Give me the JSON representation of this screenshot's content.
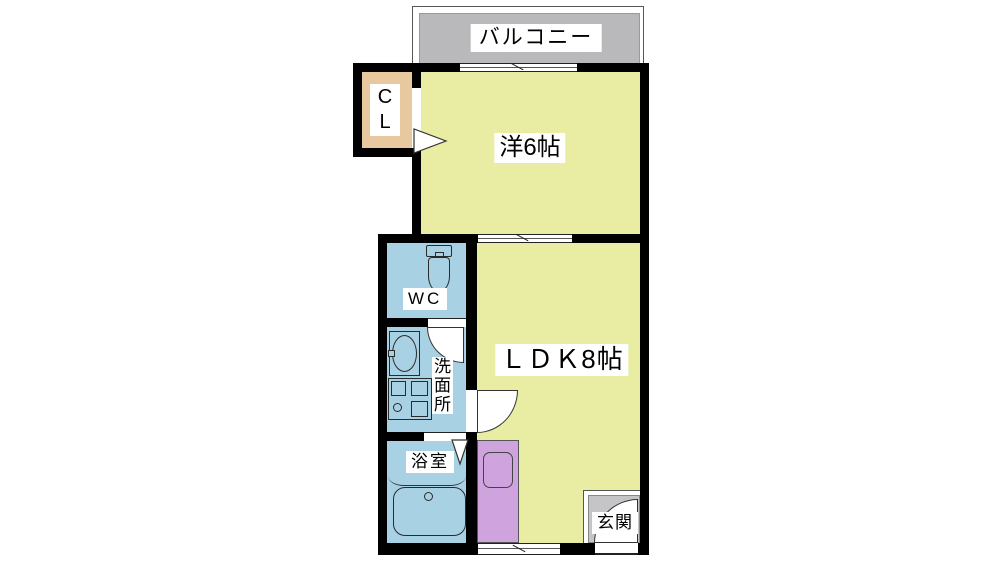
{
  "plan_type": "floor-plan",
  "rooms": {
    "balcony": {
      "label": "バルコニー"
    },
    "closet": {
      "label": "CL",
      "chars": [
        "C",
        "L"
      ]
    },
    "bedroom": {
      "label": "洋6帖"
    },
    "wc": {
      "label": "WC"
    },
    "washroom": {
      "label": "洗面所",
      "chars": [
        "洗",
        "面",
        "所"
      ]
    },
    "ldk": {
      "label": "ＬＤＫ8帖"
    },
    "bathroom": {
      "label": "浴室"
    },
    "entrance": {
      "label": "玄関"
    }
  },
  "fixtures": [
    "toilet-icon",
    "washbasin-icon",
    "washing-machine-pan-icon",
    "bathtub-icon",
    "kitchen-sink-icon",
    "door-swing-arc",
    "door-triangle",
    "sliding-window"
  ],
  "colors": {
    "room_yellow": "#e9eca3",
    "wet_area_blue": "#a9d1e4",
    "closet_tan": "#e8c89e",
    "kitchen_purple": "#cfa3de",
    "balcony_gray": "#b9b9bb",
    "entrance_gray": "#c5c5c7",
    "wall_black": "#000000"
  }
}
